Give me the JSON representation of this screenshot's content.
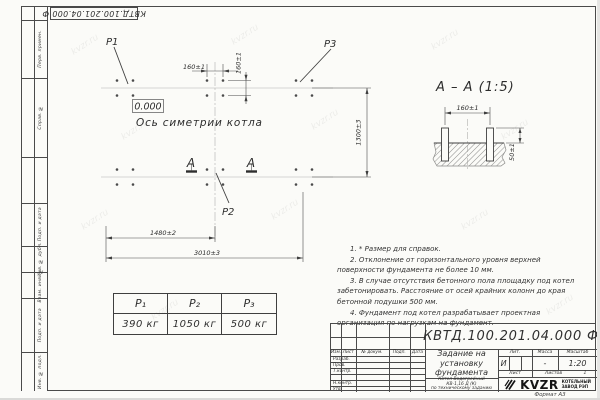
{
  "frame": {
    "stamp_label": "КВТД.100.201.04.000 Ф",
    "margin_labels": [
      "Перв. примен.",
      "Справ. №",
      "Подп. и дата",
      "Инв. № дубл.",
      "Взам. инв. №",
      "Подп. и дата",
      "Инв. № подл."
    ],
    "format_note": "Формат А3",
    "watermark": "kvzr.ru"
  },
  "plan": {
    "point1": "P1",
    "point2": "P2",
    "point3": "P3",
    "elevation_mark": "0.000",
    "axis_caption": "Ось симетрии котла",
    "section_letter": "А",
    "dims": {
      "bolt_h": "160±1",
      "bolt_v": "160±1",
      "row_spacing": "1300±3",
      "mid_span": "1480±2",
      "full_span": "3010±3"
    }
  },
  "section_view": {
    "title": "А – А (1:5)",
    "dims": {
      "bolt_spacing": "160±1",
      "protrusion": "50±1"
    }
  },
  "loads_table": {
    "headers": [
      "P₁",
      "P₂",
      "P₃"
    ],
    "values": [
      "390 кг",
      "1050 кг",
      "500 кг"
    ]
  },
  "notes": {
    "items": [
      "1. * Размер для справок.",
      "2. Отклонение от горизонтального уровня верхней поверхности фундамента не более 10 мм.",
      "3. В случае отсутствия бетонного пола площадку под котел забетонировать. Расстояние от осей крайних колонн до края бетонной подушки 500 мм.",
      "4. Фундамент под котел разрабатывает проектная организация по нагрузкам на фундамент."
    ]
  },
  "title_block": {
    "designation": "КВТД.100.201.04.000 Ф",
    "doc_title_lines": [
      "Задание на",
      "установку",
      "фундамента"
    ],
    "product_lines": [
      "Котел Водогрейный",
      "КВ-1,16 Д (К)",
      "по техническому заданию"
    ],
    "header_cols": [
      "Изм.",
      "Лист",
      "№ докум.",
      "Подп.",
      "Дата"
    ],
    "row_labels": [
      "Разраб.",
      "Пров.",
      "Т.контр.",
      "",
      "Н.контр.",
      "Утв."
    ],
    "lit_label": "Лит.",
    "lit_value": "И",
    "mass_label": "Масса",
    "mass_value": "-",
    "scale_label": "Масштаб",
    "scale_value": "1:20",
    "sheet_label": "Лист",
    "sheets_label": "Листов",
    "sheets_value": "1",
    "company": {
      "logo": "KVZR",
      "sub_lines": [
        "КОТЕЛЬНЫЙ",
        "ЗАВОД РЭП"
      ]
    }
  }
}
